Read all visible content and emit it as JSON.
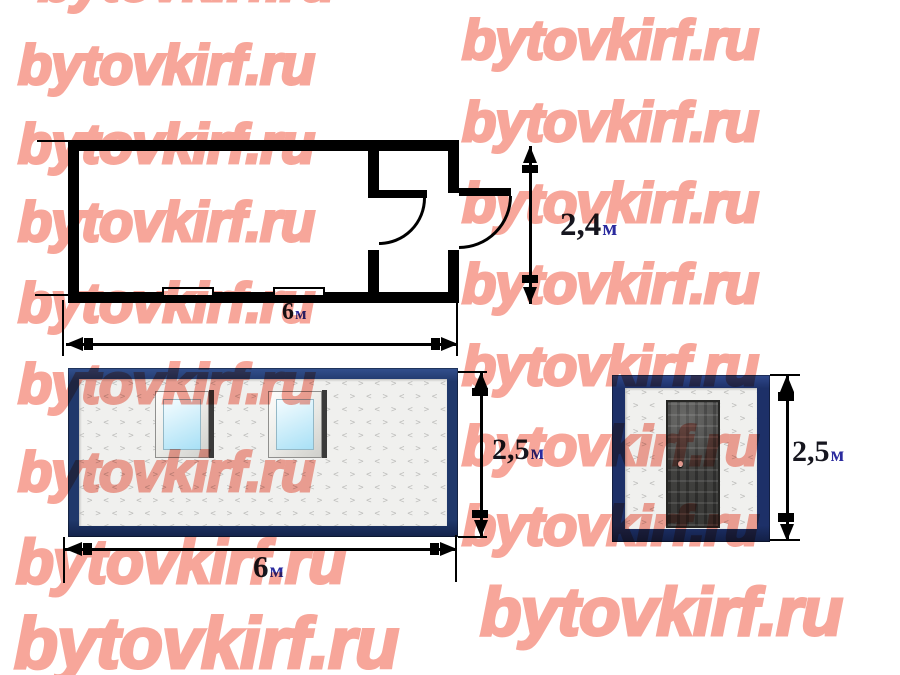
{
  "watermark": {
    "text": "bytovkirf.ru",
    "color": "#f7a69a",
    "font_size_default": 56,
    "tiles": [
      {
        "x": 38,
        "y": -40
      },
      {
        "x": 18,
        "y": 43
      },
      {
        "x": 18,
        "y": 122
      },
      {
        "x": 18,
        "y": 200
      },
      {
        "x": 18,
        "y": 281
      },
      {
        "x": 18,
        "y": 362
      },
      {
        "x": 18,
        "y": 450
      },
      {
        "x": 16,
        "y": 538,
        "s": 62
      },
      {
        "x": 14,
        "y": 614,
        "s": 72
      },
      {
        "x": 462,
        "y": 18
      },
      {
        "x": 462,
        "y": 100
      },
      {
        "x": 462,
        "y": 181
      },
      {
        "x": 462,
        "y": 262
      },
      {
        "x": 462,
        "y": 344
      },
      {
        "x": 462,
        "y": 424
      },
      {
        "x": 462,
        "y": 504
      },
      {
        "x": 480,
        "y": 584,
        "s": 68
      }
    ]
  },
  "views": {
    "plan": {
      "title": "floor plan",
      "width_label": {
        "value": "6",
        "unit": "м"
      },
      "height_label": {
        "value": "2,4",
        "unit": "м"
      }
    },
    "front": {
      "title": "front elevation",
      "width_label": {
        "value": "6",
        "unit": "м"
      },
      "height_label": {
        "value": "2,5",
        "unit": "м"
      }
    },
    "side": {
      "title": "side elevation",
      "height_label": {
        "value": "2,5",
        "unit": "м"
      }
    }
  },
  "colors": {
    "watermark_pink": "#f7a69a",
    "front_frame_navy": "#20386b",
    "side_frame_navy": "#1d3068",
    "wall_black": "#000000",
    "glass_blue": "#a8e0f6",
    "label_number": "#16161f",
    "label_unit": "#2b2b9e"
  }
}
